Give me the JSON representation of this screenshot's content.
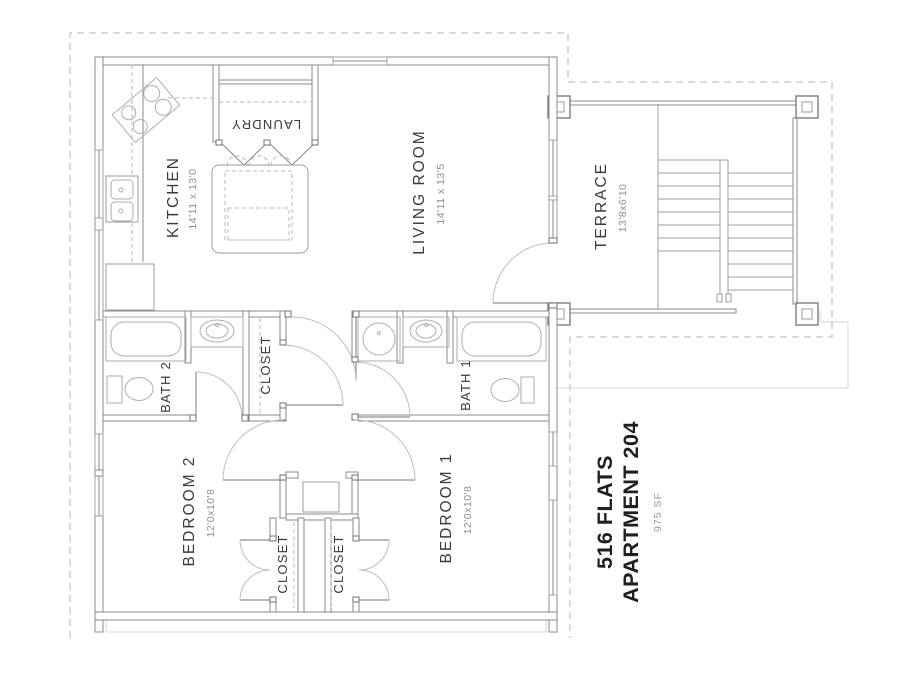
{
  "drawing": {
    "title": {
      "project": "516 FLATS",
      "unit": "APARTMENT 204",
      "area": "975 SF"
    },
    "rooms": {
      "kitchen": {
        "name": "KITCHEN",
        "dims": "14'11 x 13'0"
      },
      "living": {
        "name": "LIVING ROOM",
        "dims": "14'11 x 13'5"
      },
      "terrace": {
        "name": "TERRACE",
        "dims": "13'8x6'10"
      },
      "laundry": {
        "name": "LAUNDRY"
      },
      "bath2": {
        "name": "BATH 2"
      },
      "bath1": {
        "name": "BATH 1"
      },
      "closet_hall": {
        "name": "CLOSET"
      },
      "closet_bed2": {
        "name": "CLOSET"
      },
      "closet_bed1": {
        "name": "CLOSET"
      },
      "bedroom2": {
        "name": "BEDROOM 2",
        "dims": "12'0x10'8"
      },
      "bedroom1": {
        "name": "BEDROOM 1",
        "dims": "12'0x10'8"
      }
    },
    "colors": {
      "wall": "#8a8a8a",
      "fixture": "#aeaeae",
      "dashed_boundary": "#b5b5b5",
      "label_text": "#3a3a3a",
      "dim_text": "#8f8f8f",
      "background": "#ffffff"
    }
  }
}
